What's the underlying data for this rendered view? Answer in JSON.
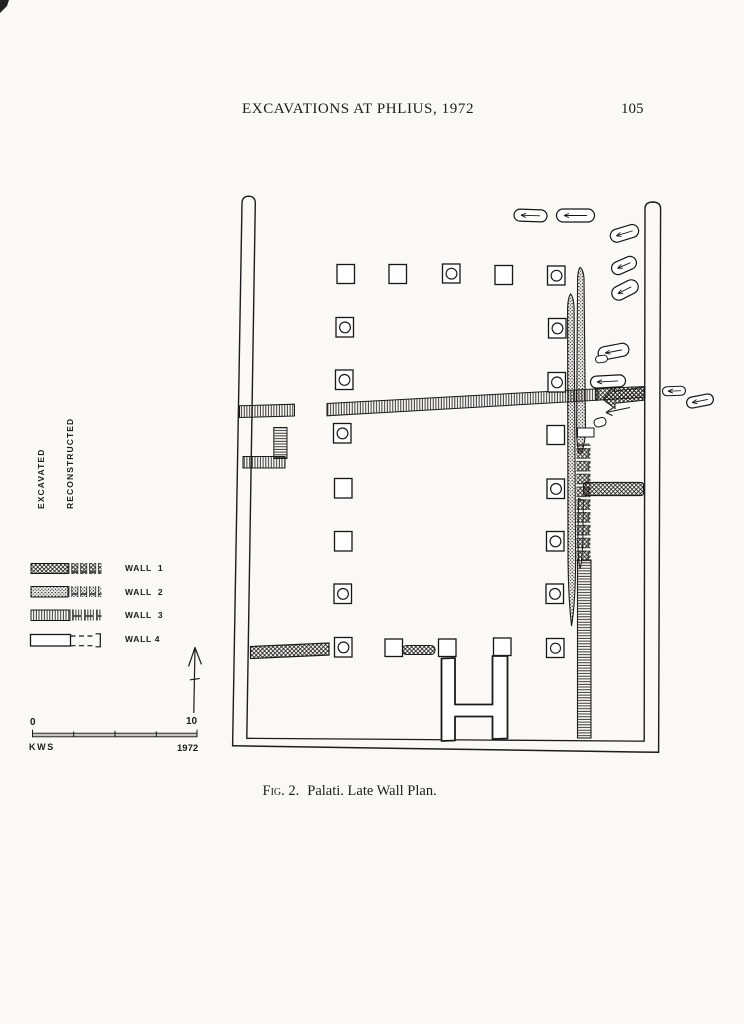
{
  "colors": {
    "paper": "#faf9f6",
    "ink": "#1c1c1c"
  },
  "header": {
    "title": "EXCAVATIONS AT PHLIUS, 1972",
    "page_number": "105"
  },
  "legend": {
    "excavated_label": "EXCAVATED",
    "reconstructed_label": "RECONSTRUCTED",
    "walls": [
      {
        "label": "WALL  1",
        "excavated_pattern": "diagonal-crosshatch",
        "reconstructed_pattern": "crosshatch-blocks"
      },
      {
        "label": "WALL  2",
        "excavated_pattern": "stipple",
        "reconstructed_pattern": "stipple-blocks"
      },
      {
        "label": "WALL  3",
        "excavated_pattern": "fine-line-hatch",
        "reconstructed_pattern": "line-hatch-blocks"
      },
      {
        "label": "WALL 4",
        "excavated_pattern": "plain-outline",
        "reconstructed_pattern": "dashed-outline"
      }
    ]
  },
  "compass": {
    "icon": "north-arrow-icon"
  },
  "scale_bar": {
    "start_label": "0",
    "end_label": "10",
    "initials": "KWS",
    "year": "1972"
  },
  "figure_caption": {
    "prefix": "Fig. 2.",
    "text": "Palati. Late Wall Plan."
  }
}
